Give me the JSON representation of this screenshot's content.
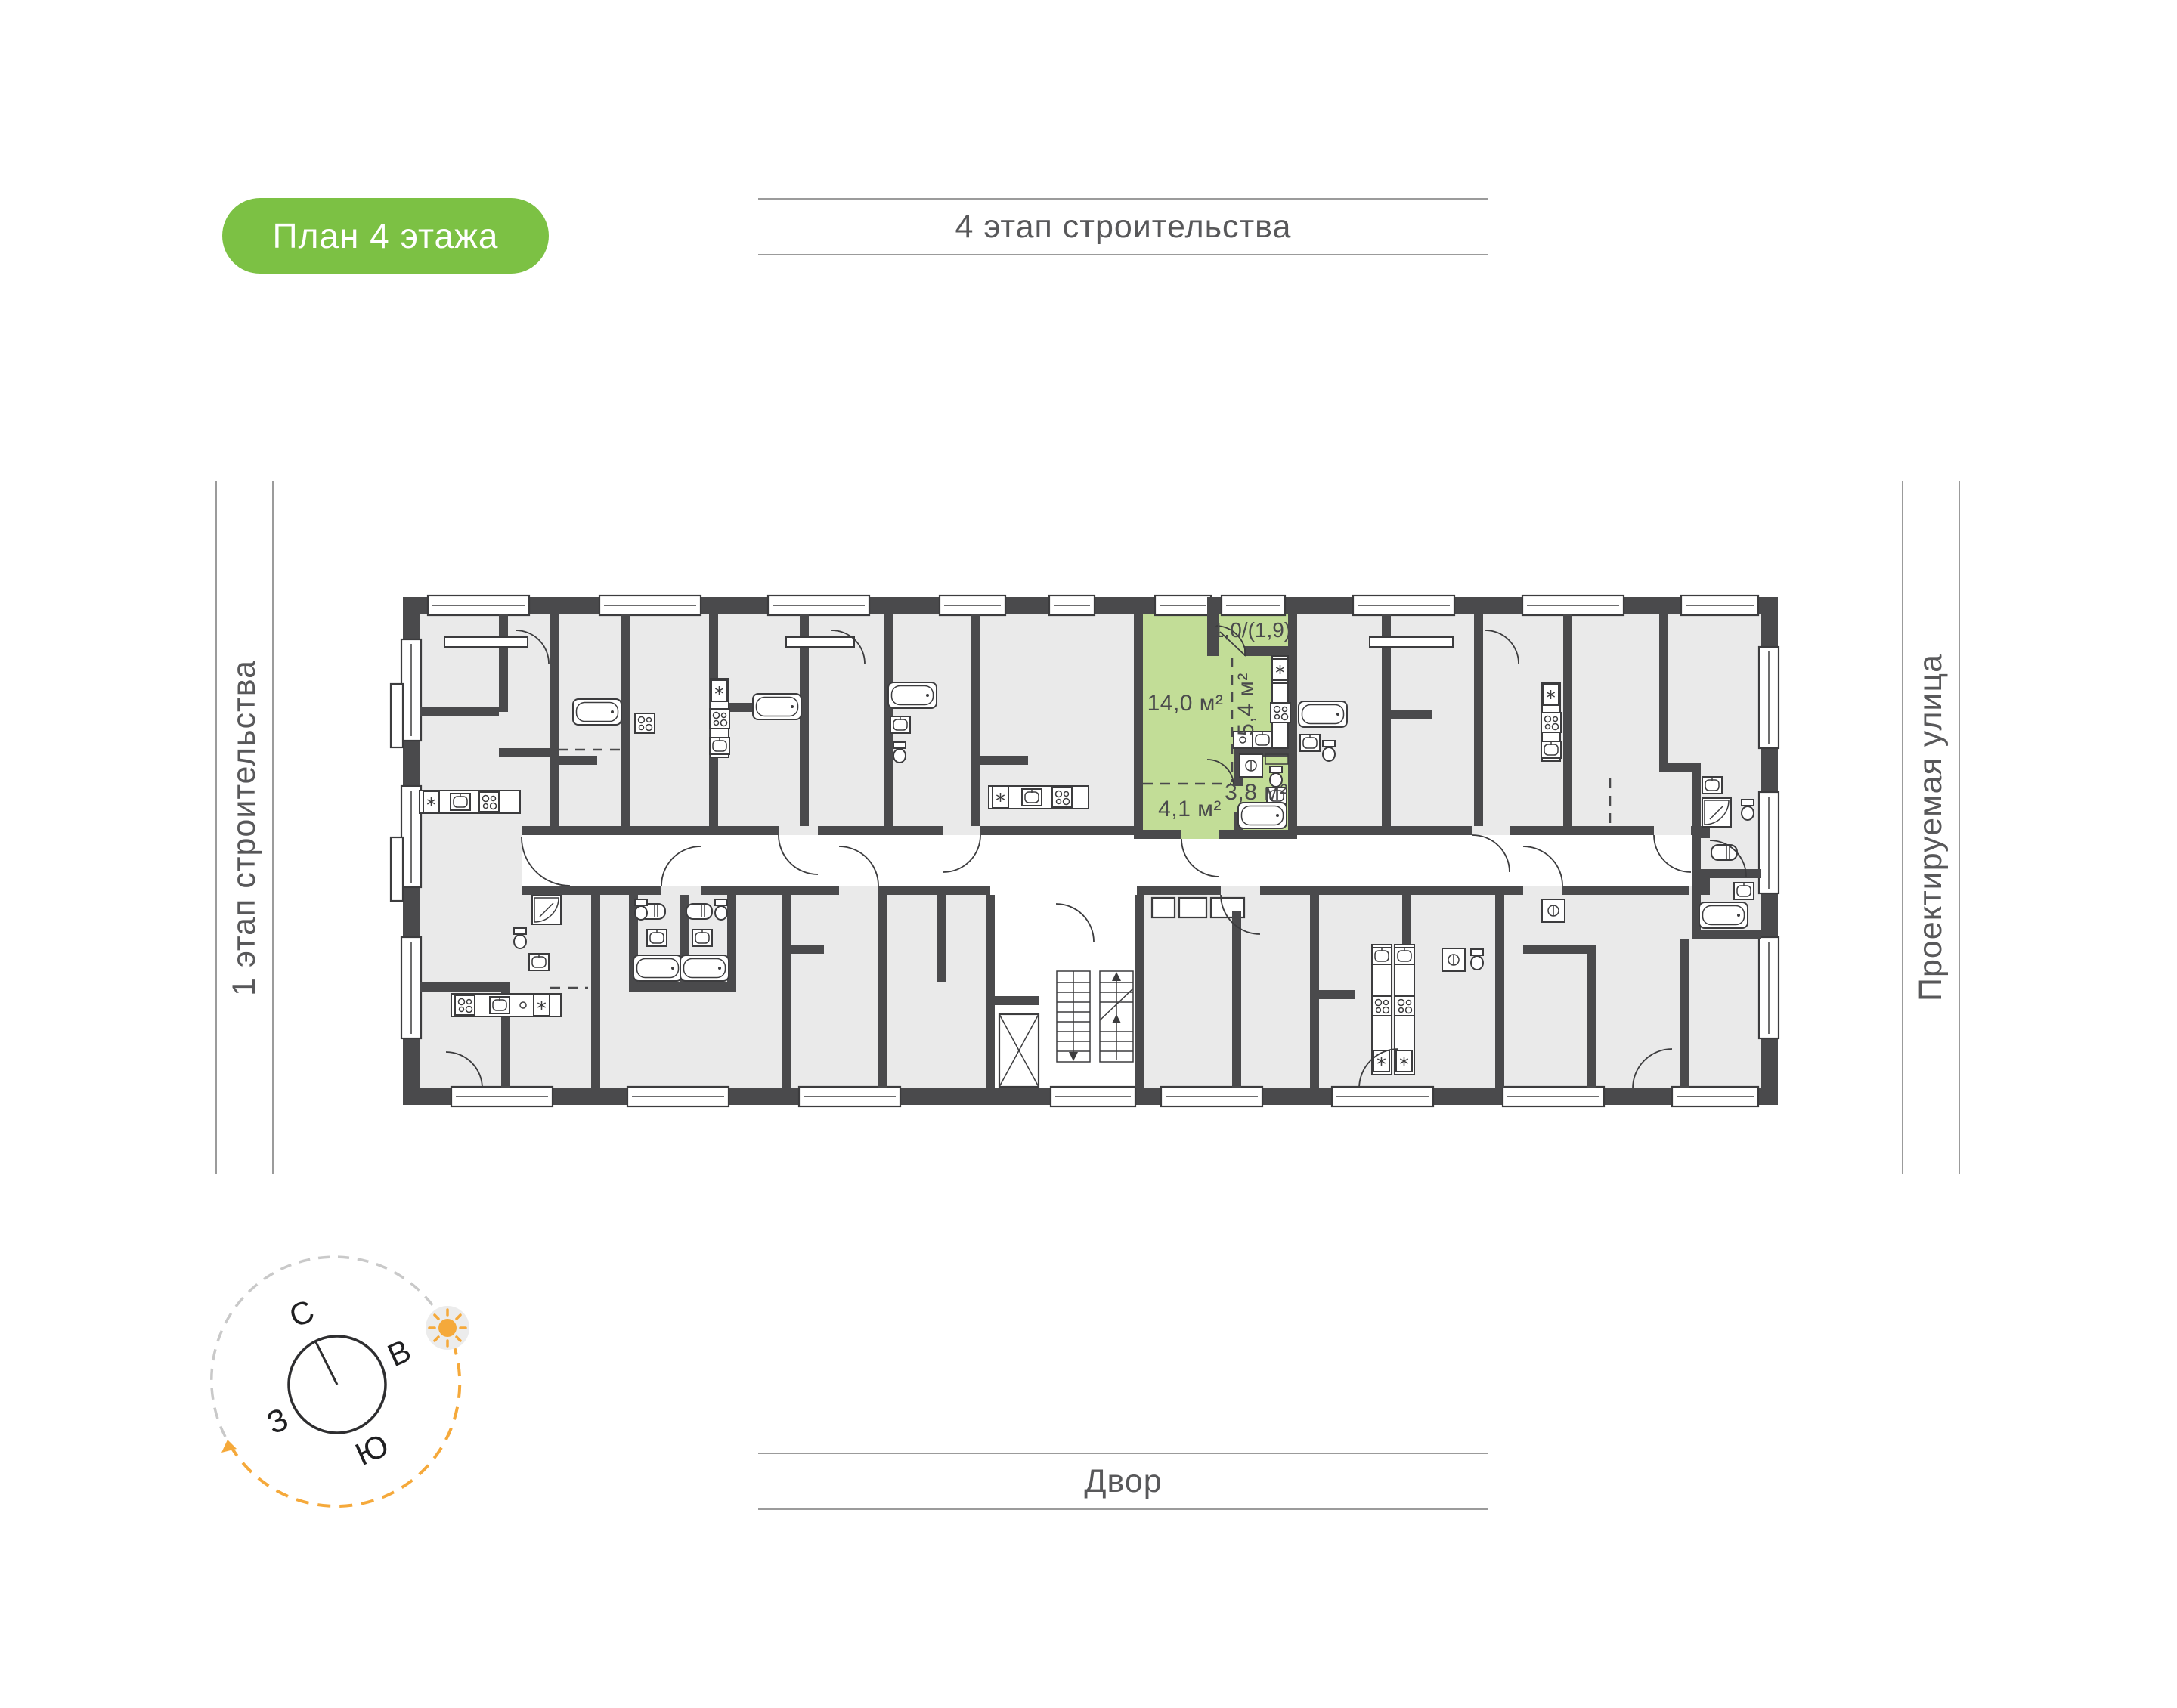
{
  "badge": {
    "label": "План 4 этажа",
    "bg": "#7CC144",
    "text_color": "#ffffff"
  },
  "labels": {
    "top": "4 этап строительства",
    "left": "1 этап строительства",
    "right": "Проектируемая улица",
    "bottom": "Двор"
  },
  "compass": {
    "north": "С",
    "east": "В",
    "south": "Ю",
    "west": "З",
    "accent": "#F5A93B"
  },
  "apartment": {
    "highlight_color": "#C2DD97",
    "rooms": [
      {
        "name": "living-room",
        "area": "14,0 м²"
      },
      {
        "name": "kitchen",
        "area": "5,4 м²"
      },
      {
        "name": "bathroom",
        "area": "3,8 м²"
      },
      {
        "name": "hallway",
        "area": "4,1 м²"
      },
      {
        "name": "balcony",
        "area": "1,0/(1,9)"
      }
    ]
  },
  "plan": {
    "wall_color": "#4A4A4C",
    "room_color": "#EAEAEA",
    "line_color": "#9B9B9B"
  }
}
